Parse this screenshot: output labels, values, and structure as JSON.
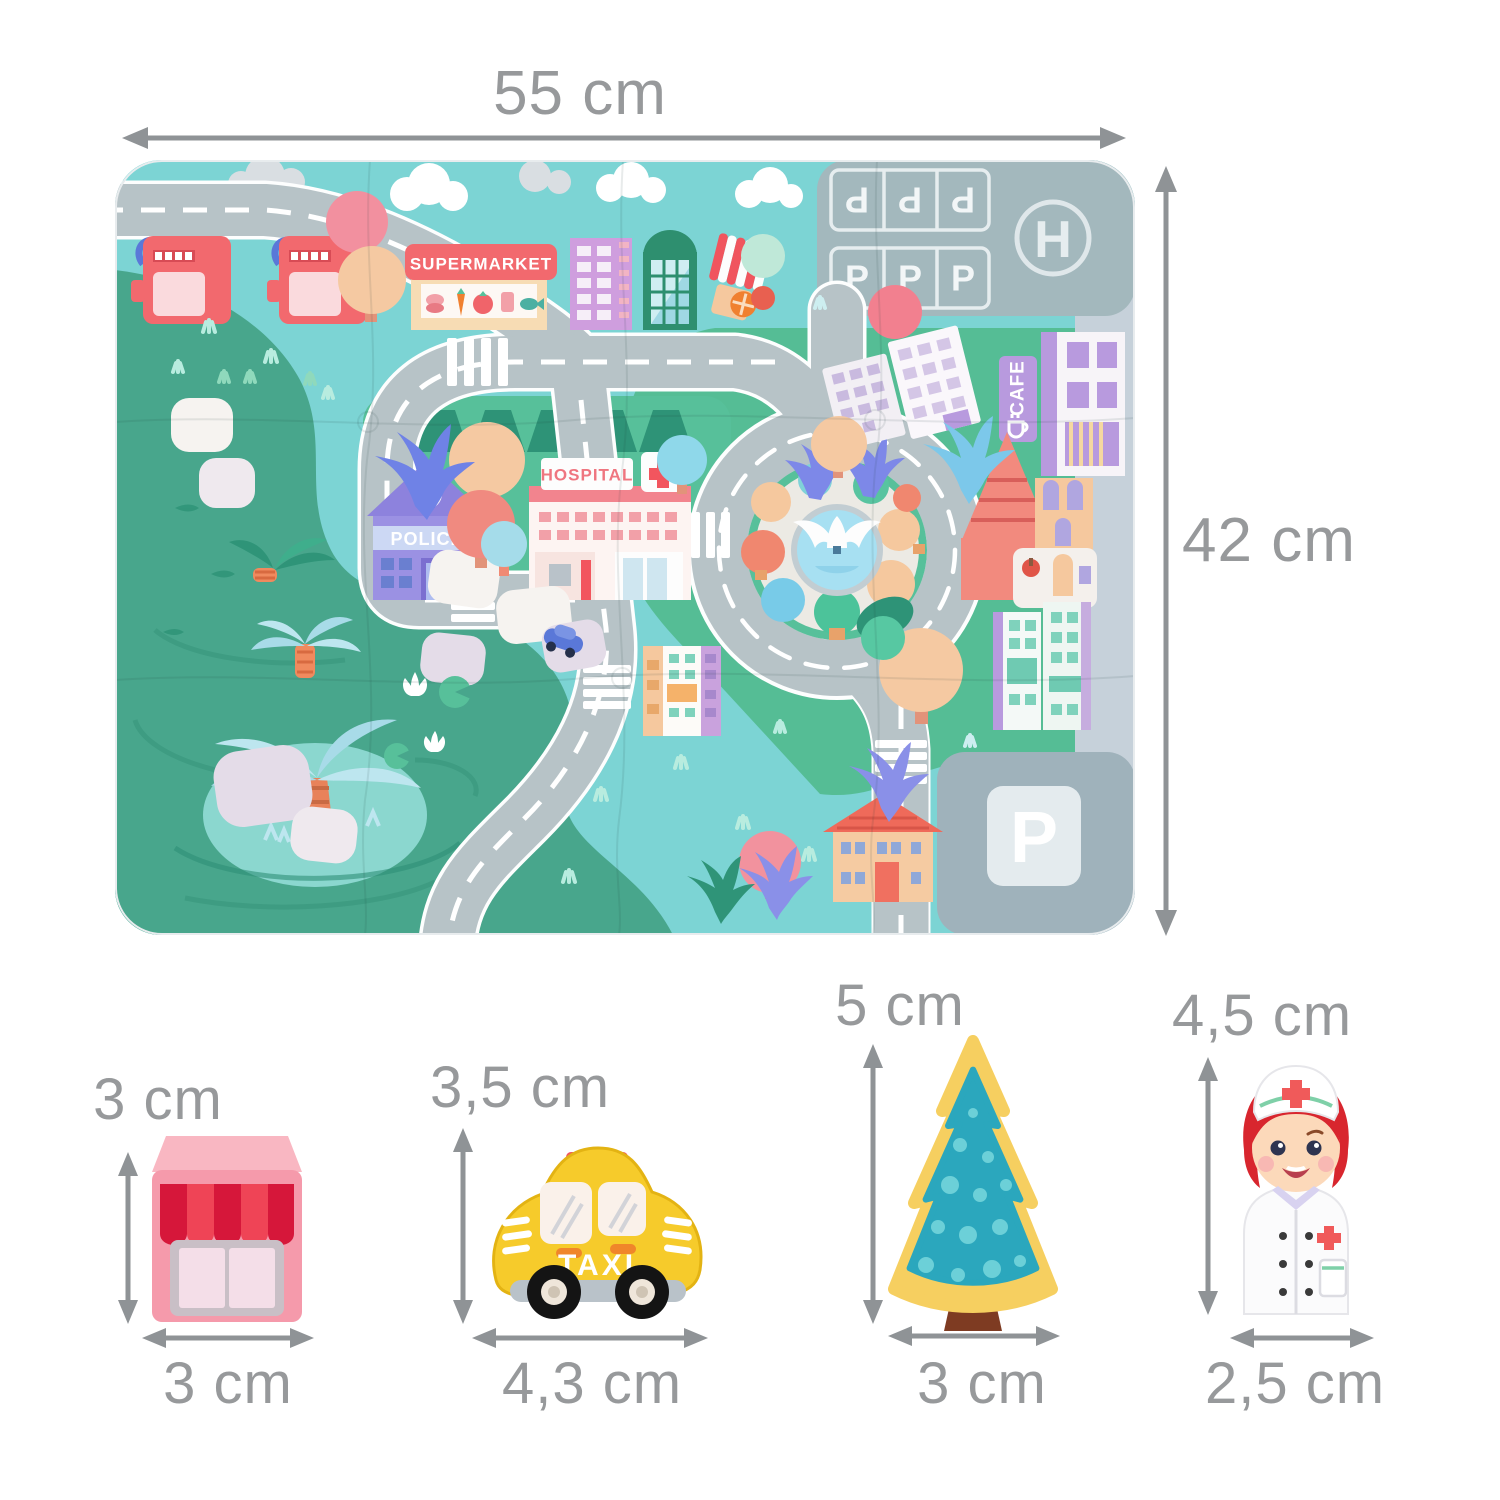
{
  "dimension_labels": {
    "mat_width": "55 cm",
    "mat_height": "42 cm"
  },
  "mat": {
    "supermarket_sign": "SUPERMARKET",
    "police_sign": "POLICE",
    "hospital_sign": "HOSPITAL",
    "cafe_sign": "CAFE",
    "parking_letter": "P",
    "helipad_letter": "H"
  },
  "toys": [
    {
      "id": "shop",
      "height_label": "3 cm",
      "width_label": "3 cm"
    },
    {
      "id": "taxi",
      "height_label": "3,5 cm",
      "width_label": "4,3 cm",
      "sign": "TAXI"
    },
    {
      "id": "tree",
      "height_label": "5 cm",
      "width_label": "3 cm"
    },
    {
      "id": "nurse",
      "height_label": "4,5 cm",
      "width_label": "2,5 cm"
    }
  ],
  "colors": {
    "dimension_text": "#97999b",
    "arrow": "#8f9396",
    "mat_sky": "#7cd4d4",
    "mat_water": "#48a68c",
    "mat_grass": "#55bd95",
    "road": "#b7c3c7",
    "shop_pink": "#f59aab",
    "taxi_yellow": "#f6cb2b",
    "tree_teal": "#2ba7bd",
    "tree_outline": "#f6cf60"
  }
}
